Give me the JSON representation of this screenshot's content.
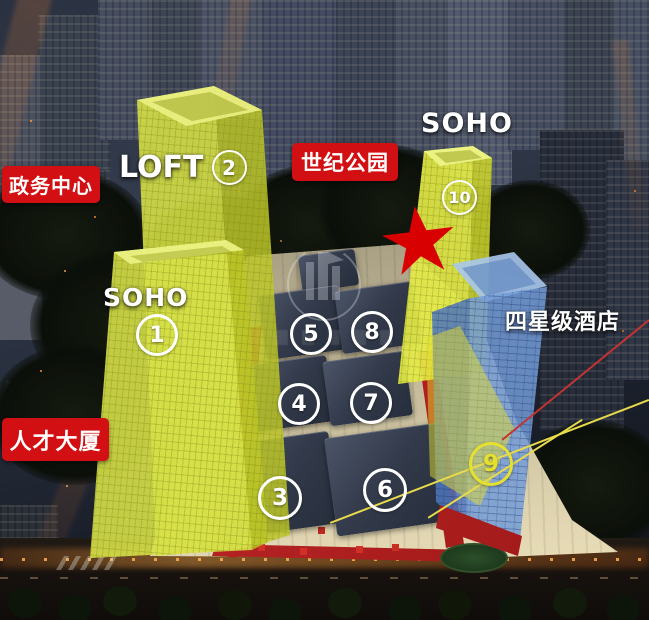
{
  "colors": {
    "label_red": "#d20f12",
    "highlight_yellow": "#dce34e",
    "highlight_blue": "#6f9fd9",
    "marker_white": "#ffffff",
    "marker_yellow": "#e6e02e",
    "star_red": "#d80000",
    "line_red": "#c23333",
    "line_yellow": "#e8da4a"
  },
  "red_labels": {
    "gov_center": "政务中心",
    "century_park": "世纪公园",
    "talent_tower": "人才大厦"
  },
  "building_texts": {
    "loft": "LOFT",
    "soho_upper": "SOHO",
    "soho_lower": "SOHO",
    "hotel": "四星级酒店"
  },
  "markers": {
    "m1": "1",
    "m2": "2",
    "m3": "3",
    "m4": "4",
    "m5": "5",
    "m6": "6",
    "m7": "7",
    "m8": "8",
    "m9": "9",
    "m10": "10"
  }
}
